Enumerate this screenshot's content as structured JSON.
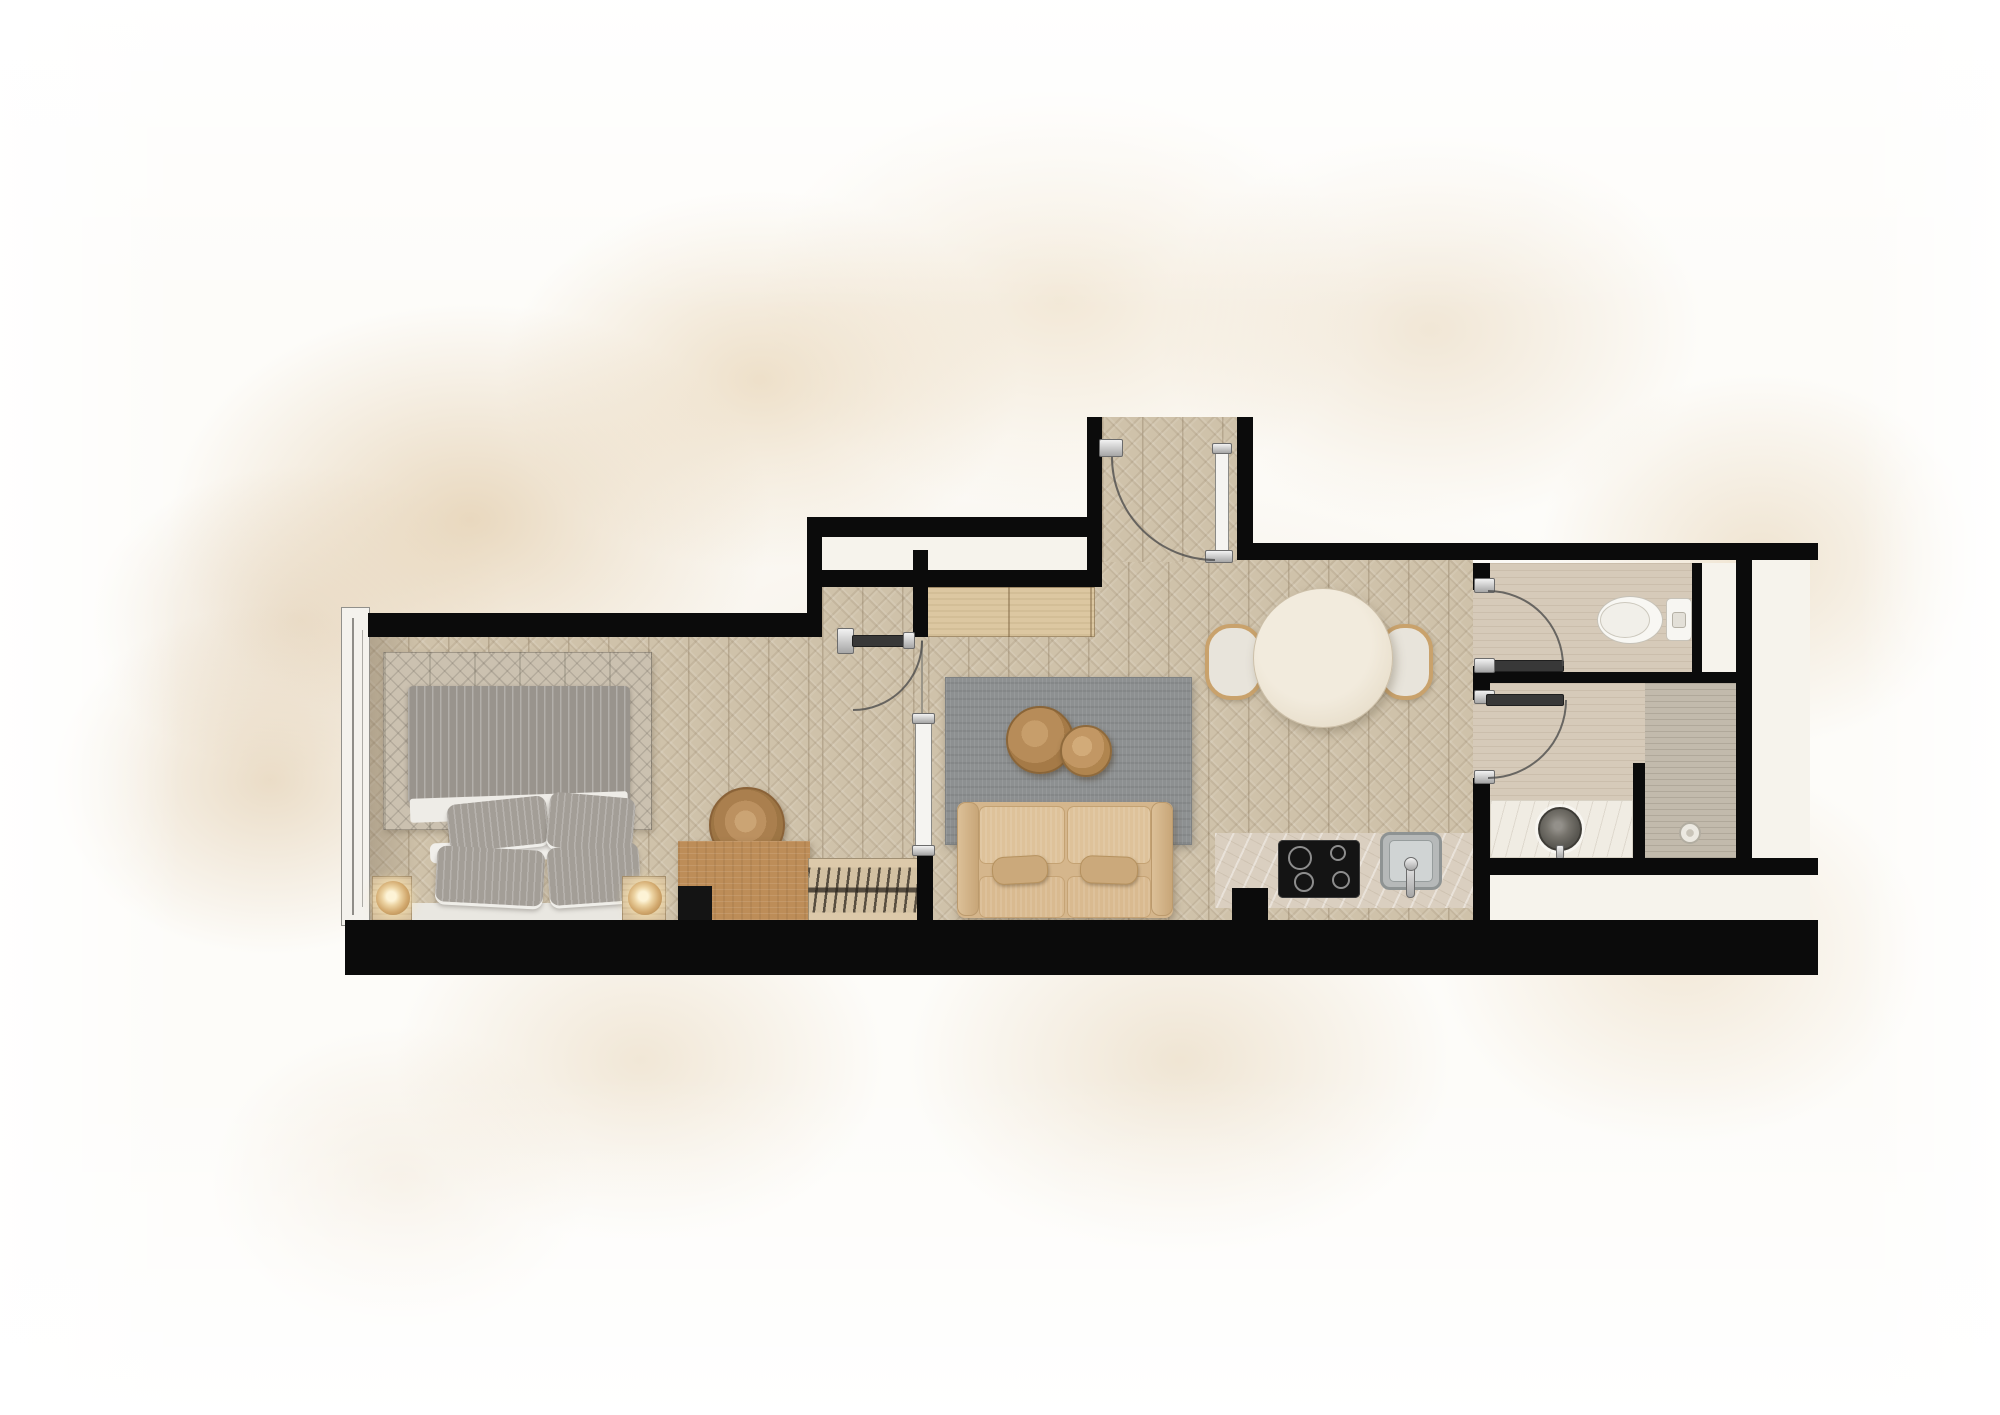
{
  "meta": {
    "type": "apartment-floor-plan-rendering",
    "canvas": {
      "width": 2000,
      "height": 1415
    },
    "rooms": [
      "bedroom",
      "hallway",
      "living-room",
      "dining-area",
      "kitchen",
      "entry-vestibule",
      "wc",
      "shower-room"
    ]
  },
  "palette": {
    "wall_black": "#0b0b0b",
    "wood_floor": "#cfc2aa",
    "bath_tile": "#d6cab9",
    "shower_tile": "#c2baac",
    "shaft_white": "#f6f3ec",
    "sofa_beige": "#d5b68c",
    "rug_living_gray": "#8d9091",
    "rug_bedroom": "#cbc1b0",
    "bed_gray": "#99948d",
    "wood_furniture": "#bd8d58",
    "wardrobe_wood": "#dcc7a1",
    "fixture_white": "#f7f6f2",
    "counter_travertine": "#dacfc0",
    "cooktop_black": "#141414",
    "chrome": "#c9c9c9",
    "background_wash": "#e3ceae"
  },
  "floorplan": {
    "layers": [
      {
        "n": "bedroom-floor",
        "c": "chevron",
        "x": 368,
        "y": 637,
        "w": 454,
        "h": 285
      },
      {
        "n": "bedroom-doorway-floor",
        "c": "chevron",
        "x": 822,
        "y": 587,
        "w": 91,
        "h": 335
      },
      {
        "n": "hall-gap-floor",
        "c": "chevron",
        "x": 913,
        "y": 637,
        "w": 15,
        "h": 285
      },
      {
        "n": "living-dining-floor",
        "c": "chevron",
        "x": 928,
        "y": 543,
        "w": 545,
        "h": 379
      },
      {
        "n": "entry-vestibule-floor",
        "c": "chevron",
        "x": 1102,
        "y": 417,
        "w": 135,
        "h": 145
      },
      {
        "n": "wc-floor",
        "c": "tile",
        "x": 1473,
        "y": 563,
        "w": 219,
        "h": 109
      },
      {
        "n": "shower-room-floor",
        "c": "tile",
        "x": 1473,
        "y": 683,
        "w": 263,
        "h": 175
      },
      {
        "n": "shower-zone-floor",
        "c": "tileDark",
        "x": 1645,
        "y": 683,
        "w": 91,
        "h": 175
      },
      {
        "n": "wall-cavity-white",
        "c": "white",
        "x": 822,
        "y": 537,
        "w": 280,
        "h": 33
      },
      {
        "n": "wc-shaft-white",
        "c": "white",
        "x": 1702,
        "y": 563,
        "w": 43,
        "h": 109
      },
      {
        "n": "right-shaft-white",
        "c": "white",
        "x": 1752,
        "y": 560,
        "w": 58,
        "h": 298
      },
      {
        "n": "bottom-right-ledge-white",
        "c": "white",
        "x": 1490,
        "y": 875,
        "w": 320,
        "h": 45
      },
      {
        "n": "bedroom-floor-shading",
        "x": 368,
        "y": 637,
        "w": 52,
        "h": 283,
        "bg": "linear-gradient(90deg, rgba(96,80,60,.28), rgba(96,80,60,0))"
      },
      {
        "n": "window-frame",
        "c": "winFrame",
        "x": 341,
        "y": 607,
        "w": 29,
        "h": 319
      },
      {
        "n": "window-glass-line",
        "c": "line",
        "x": 352,
        "y": 618,
        "w": 2,
        "h": 297
      },
      {
        "n": "window-glass-line",
        "c": "line",
        "x": 362,
        "y": 630,
        "w": 1,
        "h": 277,
        "op": 0.7
      },
      {
        "n": "bedroom-rug",
        "c": "rugBed",
        "x": 383,
        "y": 652,
        "w": 269,
        "h": 178
      },
      {
        "n": "bed-frame",
        "x": 388,
        "y": 903,
        "w": 262,
        "h": 19,
        "bg": "#e9e7e1",
        "br": 2
      },
      {
        "n": "bed-duvet",
        "c": "duvet",
        "x": 408,
        "y": 686,
        "w": 222,
        "h": 118
      },
      {
        "n": "bed-sheet-fold",
        "x": 410,
        "y": 795,
        "w": 218,
        "h": 24,
        "bg": "#eeece7",
        "rot": -2,
        "br": 3
      },
      {
        "n": "bed-pillow-white",
        "x": 430,
        "y": 840,
        "w": 200,
        "h": 20,
        "bg": "#f1efeb",
        "rot": -2,
        "br": 6
      },
      {
        "n": "bed-pillow-white",
        "x": 520,
        "y": 826,
        "w": 110,
        "h": 16,
        "bg": "#f1efeb",
        "rot": -7,
        "br": 6
      },
      {
        "n": "bed-pillow",
        "c": "pillow",
        "x": 448,
        "y": 800,
        "w": 100,
        "h": 48,
        "rot": -6
      },
      {
        "n": "bed-pillow",
        "c": "pillow",
        "x": 548,
        "y": 795,
        "w": 86,
        "h": 55,
        "rot": 5
      },
      {
        "n": "bed-pillow",
        "c": "pillow",
        "x": 436,
        "y": 848,
        "w": 108,
        "h": 56,
        "rot": 3
      },
      {
        "n": "bed-pillow",
        "c": "pillow",
        "x": 548,
        "y": 845,
        "w": 92,
        "h": 58,
        "rot": -4
      },
      {
        "n": "nightstand",
        "c": "woodL2",
        "x": 372,
        "y": 876,
        "w": 40,
        "h": 46
      },
      {
        "n": "bedside-lamp",
        "t": "c",
        "c": "lamp",
        "cx": 393,
        "cy": 898,
        "r": 17
      },
      {
        "n": "nightstand",
        "c": "woodL2",
        "x": 622,
        "y": 876,
        "w": 44,
        "h": 46
      },
      {
        "n": "bedside-lamp",
        "t": "c",
        "c": "lamp",
        "cx": 645,
        "cy": 898,
        "r": 17
      },
      {
        "n": "storage-basket",
        "t": "c",
        "c": "pouf",
        "cx": 747,
        "cy": 825,
        "r": 38
      },
      {
        "n": "desk",
        "c": "woodD",
        "x": 678,
        "y": 841,
        "w": 132,
        "h": 82
      },
      {
        "n": "desk-chair",
        "x": 678,
        "y": 886,
        "w": 34,
        "h": 37,
        "bg": "#141414"
      },
      {
        "n": "bookshelf",
        "c": "shelf",
        "x": 808,
        "y": 858,
        "w": 114,
        "h": 64
      },
      {
        "n": "wardrobe",
        "c": "woodL",
        "x": 927,
        "y": 587,
        "w": 168,
        "h": 50
      },
      {
        "n": "living-rug",
        "c": "rugLiv",
        "x": 945,
        "y": 677,
        "w": 247,
        "h": 168
      },
      {
        "n": "coffee-table",
        "t": "c",
        "c": "woodRound",
        "cx": 1040,
        "cy": 740,
        "r": 34
      },
      {
        "n": "coffee-table-small",
        "t": "c",
        "c": "woodRound2",
        "cx": 1086,
        "cy": 751,
        "r": 26
      },
      {
        "n": "sofa-base",
        "c": "sofaBase",
        "x": 957,
        "y": 802,
        "w": 216,
        "h": 116
      },
      {
        "n": "sofa-back-cushion",
        "c": "sofaBack",
        "x": 979,
        "y": 806,
        "w": 86,
        "h": 58
      },
      {
        "n": "sofa-back-cushion",
        "c": "sofaBack",
        "x": 1067,
        "y": 806,
        "w": 84,
        "h": 58
      },
      {
        "n": "sofa-arm",
        "c": "sofaArm",
        "x": 957,
        "y": 802,
        "w": 22,
        "h": 114
      },
      {
        "n": "sofa-arm",
        "c": "sofaArm",
        "x": 1151,
        "y": 802,
        "w": 22,
        "h": 114
      },
      {
        "n": "sofa-seat-cushion",
        "c": "sofaSeat",
        "x": 979,
        "y": 876,
        "w": 86,
        "h": 42
      },
      {
        "n": "sofa-seat-cushion",
        "c": "sofaSeat",
        "x": 1067,
        "y": 876,
        "w": 84,
        "h": 42
      },
      {
        "n": "sofa-pillow",
        "c": "sofaPillow",
        "x": 992,
        "y": 856,
        "w": 56,
        "h": 28,
        "rot": -3
      },
      {
        "n": "sofa-pillow",
        "c": "sofaPillow",
        "x": 1080,
        "y": 856,
        "w": 58,
        "h": 28,
        "rot": 2
      },
      {
        "n": "dining-bench",
        "c": "bench",
        "x": 1205,
        "y": 624,
        "w": 58,
        "h": 76
      },
      {
        "n": "dining-bench",
        "c": "bench",
        "x": 1378,
        "y": 624,
        "w": 55,
        "h": 76
      },
      {
        "n": "dining-table",
        "t": "c",
        "c": "tableRound",
        "cx": 1323,
        "cy": 658,
        "r": 70
      },
      {
        "n": "kitchen-counter",
        "c": "counter",
        "x": 1215,
        "y": 833,
        "w": 260,
        "h": 75
      },
      {
        "n": "kitchen-counter-return",
        "x": 1232,
        "y": 888,
        "w": 36,
        "h": 40,
        "bg": "#0b0b0b"
      },
      {
        "n": "cooktop",
        "c": "cooktop",
        "x": 1278,
        "y": 840,
        "w": 82,
        "h": 58
      },
      {
        "n": "cooktop-burner",
        "t": "c",
        "c": "burner",
        "cx": 1300,
        "cy": 858,
        "r": 12
      },
      {
        "n": "cooktop-burner",
        "t": "c",
        "c": "burner",
        "cx": 1338,
        "cy": 853,
        "r": 8
      },
      {
        "n": "cooktop-burner",
        "t": "c",
        "c": "burner",
        "cx": 1304,
        "cy": 882,
        "r": 10
      },
      {
        "n": "cooktop-burner",
        "t": "c",
        "c": "burner",
        "cx": 1341,
        "cy": 880,
        "r": 9
      },
      {
        "n": "kitchen-sink",
        "c": "sinkOuter",
        "x": 1380,
        "y": 832,
        "w": 62,
        "h": 58
      },
      {
        "n": "kitchen-sink-basin",
        "c": "sinkInner",
        "x": 1389,
        "y": 840,
        "w": 44,
        "h": 42
      },
      {
        "n": "kitchen-faucet",
        "c": "chrome",
        "x": 1406,
        "y": 858,
        "w": 9,
        "h": 40,
        "br": 4
      },
      {
        "n": "kitchen-faucet-base",
        "t": "c",
        "c": "chrome",
        "cx": 1411,
        "cy": 864,
        "r": 7
      },
      {
        "n": "vanity-counter",
        "c": "marble",
        "x": 1490,
        "y": 800,
        "w": 143,
        "h": 58
      },
      {
        "n": "vanity-basin",
        "t": "c",
        "c": "basin",
        "cx": 1560,
        "cy": 829,
        "r": 22
      },
      {
        "n": "vanity-faucet",
        "c": "chrome",
        "x": 1556,
        "y": 845,
        "w": 8,
        "h": 14
      },
      {
        "n": "vanity-faucet-dot",
        "t": "c",
        "cx": 1560,
        "cy": 864,
        "r": 2,
        "bg": "#555555"
      },
      {
        "n": "vanity-faucet-dot",
        "t": "c",
        "cx": 1560,
        "cy": 871,
        "r": 2,
        "bg": "#555555"
      },
      {
        "n": "shower-drain",
        "t": "c",
        "c": "drain",
        "cx": 1690,
        "cy": 833,
        "r": 11
      },
      {
        "n": "toilet-tank",
        "x": 1666,
        "y": 598,
        "w": 26,
        "h": 43,
        "bg": "#f7f6f2",
        "bd": "1.5px solid #c6c2b8",
        "br": 5
      },
      {
        "n": "toilet-bowl",
        "t": "e",
        "cx": 1630,
        "cy": 620,
        "rx": 33,
        "ry": 24,
        "bg": "#f8f7f3",
        "bd": "1.5px solid #c6c2b8"
      },
      {
        "n": "toilet-seat",
        "t": "e",
        "cx": 1625,
        "cy": 620,
        "rx": 25,
        "ry": 18,
        "bg": "#f1efe9",
        "bd": "1px solid #ccc8bd"
      },
      {
        "n": "toilet-flush-button",
        "x": 1672,
        "y": 612,
        "w": 14,
        "h": 16,
        "bg": "#e3e0d8",
        "bd": "1px solid #b5b1a6",
        "br": 3
      },
      {
        "n": "wall",
        "c": "wall",
        "x": 368,
        "y": 613,
        "w": 454,
        "h": 24
      },
      {
        "n": "wall",
        "c": "wall",
        "x": 807,
        "y": 517,
        "w": 15,
        "h": 120
      },
      {
        "n": "wall",
        "c": "wall",
        "x": 807,
        "y": 517,
        "w": 280,
        "h": 20
      },
      {
        "n": "wall",
        "c": "wall",
        "x": 822,
        "y": 570,
        "w": 280,
        "h": 17
      },
      {
        "n": "wall",
        "c": "wall",
        "x": 1087,
        "y": 417,
        "w": 15,
        "h": 170
      },
      {
        "n": "wall",
        "c": "wall",
        "x": 1237,
        "y": 417,
        "w": 16,
        "h": 143
      },
      {
        "n": "wall",
        "c": "wall",
        "x": 1253,
        "y": 543,
        "w": 565,
        "h": 17
      },
      {
        "n": "wall",
        "c": "wall",
        "x": 913,
        "y": 550,
        "w": 15,
        "h": 87
      },
      {
        "n": "wall",
        "c": "wall",
        "x": 917,
        "y": 850,
        "w": 16,
        "h": 72
      },
      {
        "n": "wall",
        "c": "wall",
        "x": 345,
        "y": 920,
        "w": 1473,
        "h": 55
      },
      {
        "n": "wall",
        "c": "wall",
        "x": 1473,
        "y": 563,
        "w": 17,
        "h": 27
      },
      {
        "n": "wall",
        "c": "wall",
        "x": 1473,
        "y": 666,
        "w": 17,
        "h": 34
      },
      {
        "n": "wall",
        "c": "wall",
        "x": 1473,
        "y": 778,
        "w": 17,
        "h": 142
      },
      {
        "n": "wall",
        "c": "wall",
        "x": 1488,
        "y": 672,
        "w": 264,
        "h": 11
      },
      {
        "n": "wall",
        "c": "wall",
        "x": 1692,
        "y": 563,
        "w": 10,
        "h": 109
      },
      {
        "n": "wall",
        "c": "wall",
        "x": 1736,
        "y": 553,
        "w": 16,
        "h": 322
      },
      {
        "n": "wall",
        "c": "wall",
        "x": 1633,
        "y": 763,
        "w": 12,
        "h": 112
      },
      {
        "n": "wall",
        "c": "wall",
        "x": 1490,
        "y": 858,
        "w": 328,
        "h": 17
      },
      {
        "n": "entry-door-hinge",
        "c": "chrome",
        "x": 1099,
        "y": 439,
        "w": 24,
        "h": 18
      },
      {
        "n": "entry-door-leaf",
        "c": "leafWhite",
        "x": 1215,
        "y": 447,
        "w": 14,
        "h": 110
      },
      {
        "n": "entry-door-cap",
        "c": "chrome",
        "x": 1212,
        "y": 443,
        "w": 20,
        "h": 11
      },
      {
        "n": "entry-door-cap",
        "c": "chrome",
        "x": 1205,
        "y": 550,
        "w": 28,
        "h": 13
      },
      {
        "n": "bedroom-door-hinge",
        "c": "chrome",
        "x": 837,
        "y": 628,
        "w": 17,
        "h": 26
      },
      {
        "n": "bedroom-door-leaf",
        "c": "leafDark",
        "x": 852,
        "y": 635,
        "w": 61,
        "h": 12
      },
      {
        "n": "bedroom-door-cap",
        "c": "chrome",
        "x": 903,
        "y": 632,
        "w": 12,
        "h": 17
      },
      {
        "n": "hall-door-jamb-line",
        "x": 921,
        "y": 640,
        "w": 2,
        "h": 80,
        "bg": "#9a9588"
      },
      {
        "n": "hall-door-leaf",
        "c": "leafWhite",
        "x": 915,
        "y": 718,
        "w": 17,
        "h": 134
      },
      {
        "n": "hall-door-cap",
        "c": "chrome",
        "x": 912,
        "y": 713,
        "w": 23,
        "h": 11
      },
      {
        "n": "hall-door-cap",
        "c": "chrome",
        "x": 912,
        "y": 845,
        "w": 23,
        "h": 11
      },
      {
        "n": "wc-door-jamb",
        "c": "chrome",
        "x": 1474,
        "y": 578,
        "w": 21,
        "h": 15
      },
      {
        "n": "wc-door-leaf",
        "c": "leafDark",
        "x": 1486,
        "y": 660,
        "w": 78,
        "h": 12
      },
      {
        "n": "wc-door-hinge",
        "c": "chrome",
        "x": 1474,
        "y": 658,
        "w": 21,
        "h": 15
      },
      {
        "n": "shower-door-jamb",
        "c": "chrome",
        "x": 1474,
        "y": 690,
        "w": 21,
        "h": 14
      },
      {
        "n": "shower-door-leaf",
        "c": "leafDark",
        "x": 1486,
        "y": 694,
        "w": 78,
        "h": 12
      },
      {
        "n": "shower-door-hinge",
        "c": "chrome",
        "x": 1474,
        "y": 770,
        "w": 21,
        "h": 14
      }
    ],
    "door_arcs": [
      {
        "n": "bedroom-door-arc",
        "d": "M 922 641 A 69 69 0 0 1 853 710"
      },
      {
        "n": "entry-door-arc",
        "d": "M 1112 457 A 103 103 0 0 0 1215 560"
      },
      {
        "n": "wc-door-arc",
        "d": "M 1488 591 A 75 75 0 0 1 1563 666"
      },
      {
        "n": "shower-door-arc",
        "d": "M 1566 700 A 78 78 0 0 1 1488 778"
      }
    ]
  }
}
